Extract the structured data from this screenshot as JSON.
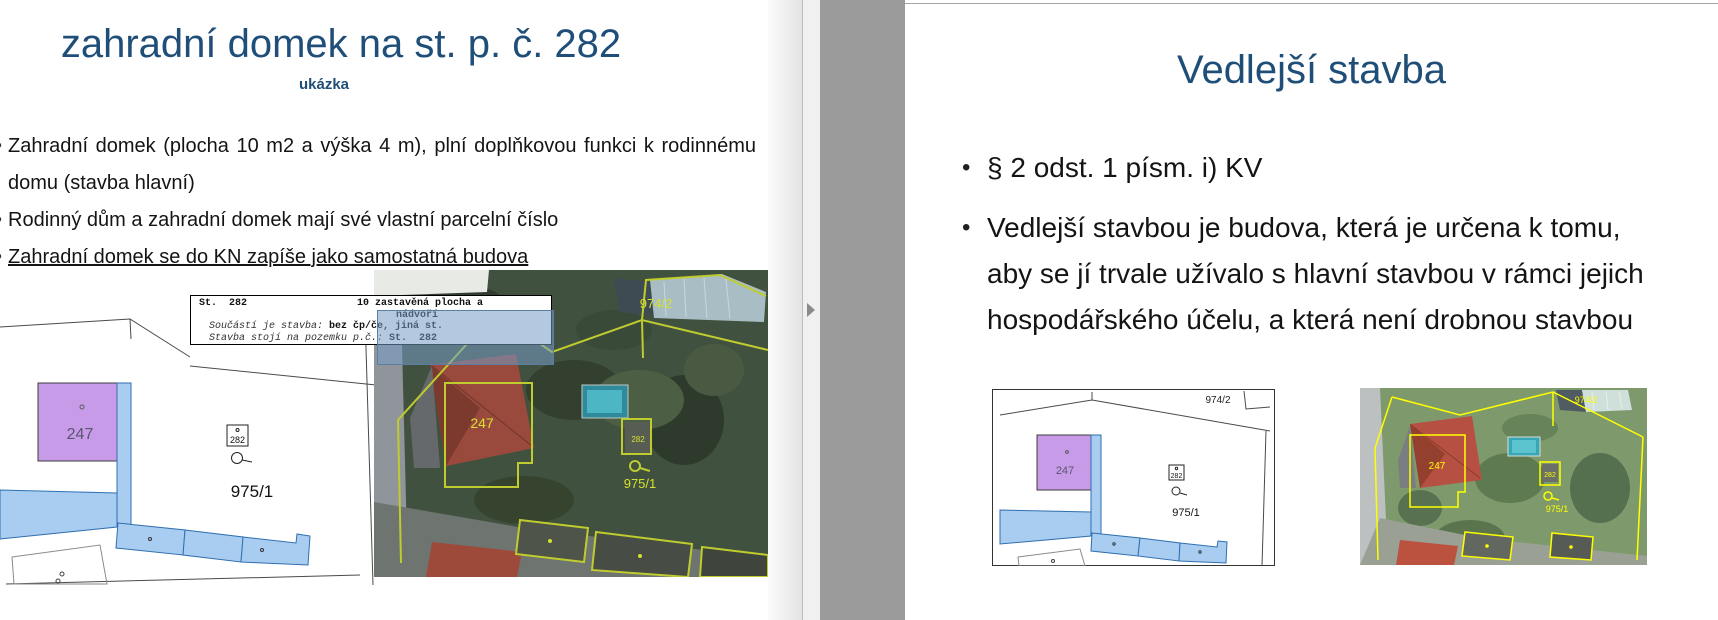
{
  "left_slide": {
    "title": "zahradní domek na st. p. č. 282",
    "subtitle": "ukázka",
    "bullets": [
      "Zahradní domek (plocha 10 m2 a výška 4 m), plní doplňkovou funkci k rodinnému domu (stavba hlavní)",
      "Rodinný dům a zahradní domek mají své vlastní parcelní číslo",
      "Zahradní domek se do KN zapíše jako samostatná budova"
    ],
    "info_box": {
      "parcel": "St.  282",
      "land_use_line1": "10 zastavěná plocha a",
      "land_use_line2": "nádvoří",
      "row2_label": "Součástí je stavba: ",
      "row2_value": "bez čp/če, jiná st.",
      "row3_label": "Stavba stojí na pozemku p.č.: ",
      "row3_value": "St.  282"
    },
    "map": {
      "parcel_247": "247",
      "building_282": "282",
      "parcel_975": "975/1"
    },
    "aerial": {
      "parcel_247": "247",
      "building_282": "282",
      "parcel_975": "975/1",
      "parcel_974": "974/2"
    }
  },
  "right_slide": {
    "title": "Vedlejší stavba",
    "bullets": [
      "§ 2 odst. 1 písm. i) KV",
      "Vedlejší stavbou je budova, která je určena k tomu, aby se jí trvale užívalo s hlavní stavbou v rámci jejich hospodářského účelu, a která není drobnou stavbou"
    ],
    "map": {
      "parcel_974": "974/2",
      "parcel_247": "247",
      "building_282": "282",
      "parcel_975": "975/1"
    },
    "aerial": {
      "parcel_974": "974/2",
      "parcel_247": "247",
      "building_282": "282",
      "parcel_975": "975/1"
    }
  },
  "colors": {
    "title_blue": "#1F4E79",
    "highlight_blue": "rgba(118,156,199,0.55)",
    "parcel_purple": "#C79BE8",
    "parcel_blue": "#A9CDF0",
    "boundary_yellow_green": "#BECC2F",
    "boundary_yellow": "#FFFF00",
    "divider_gray": "#9B9B9B"
  }
}
